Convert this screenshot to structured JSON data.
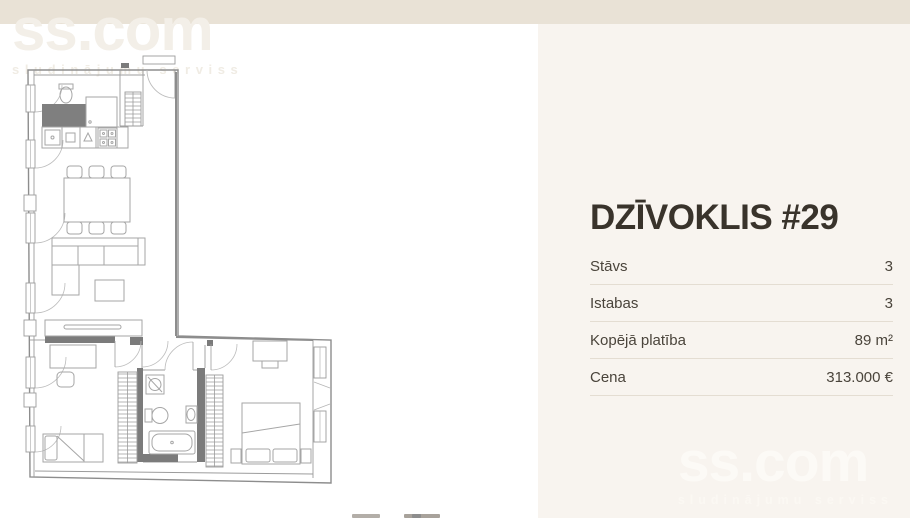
{
  "colors": {
    "topbar": "#e9e2d6",
    "panel_background": "#f8f4ef",
    "title_text": "#39332b",
    "row_text": "#4a443b",
    "divider": "#e4ddd2",
    "plan_wall": "#8d8d8d",
    "plan_dark_fill": "#7b7b7b"
  },
  "watermark": {
    "brand": "ss.com",
    "tagline": "sludinājumu serviss"
  },
  "listing": {
    "title": "DZĪVOKLIS #29",
    "details": [
      {
        "label": "Stāvs",
        "value": "3"
      },
      {
        "label": "Istabas",
        "value": "3"
      },
      {
        "label": "Kopējā platība",
        "value": "89 m²"
      },
      {
        "label": "Cena",
        "value": "313.000 €"
      }
    ]
  }
}
